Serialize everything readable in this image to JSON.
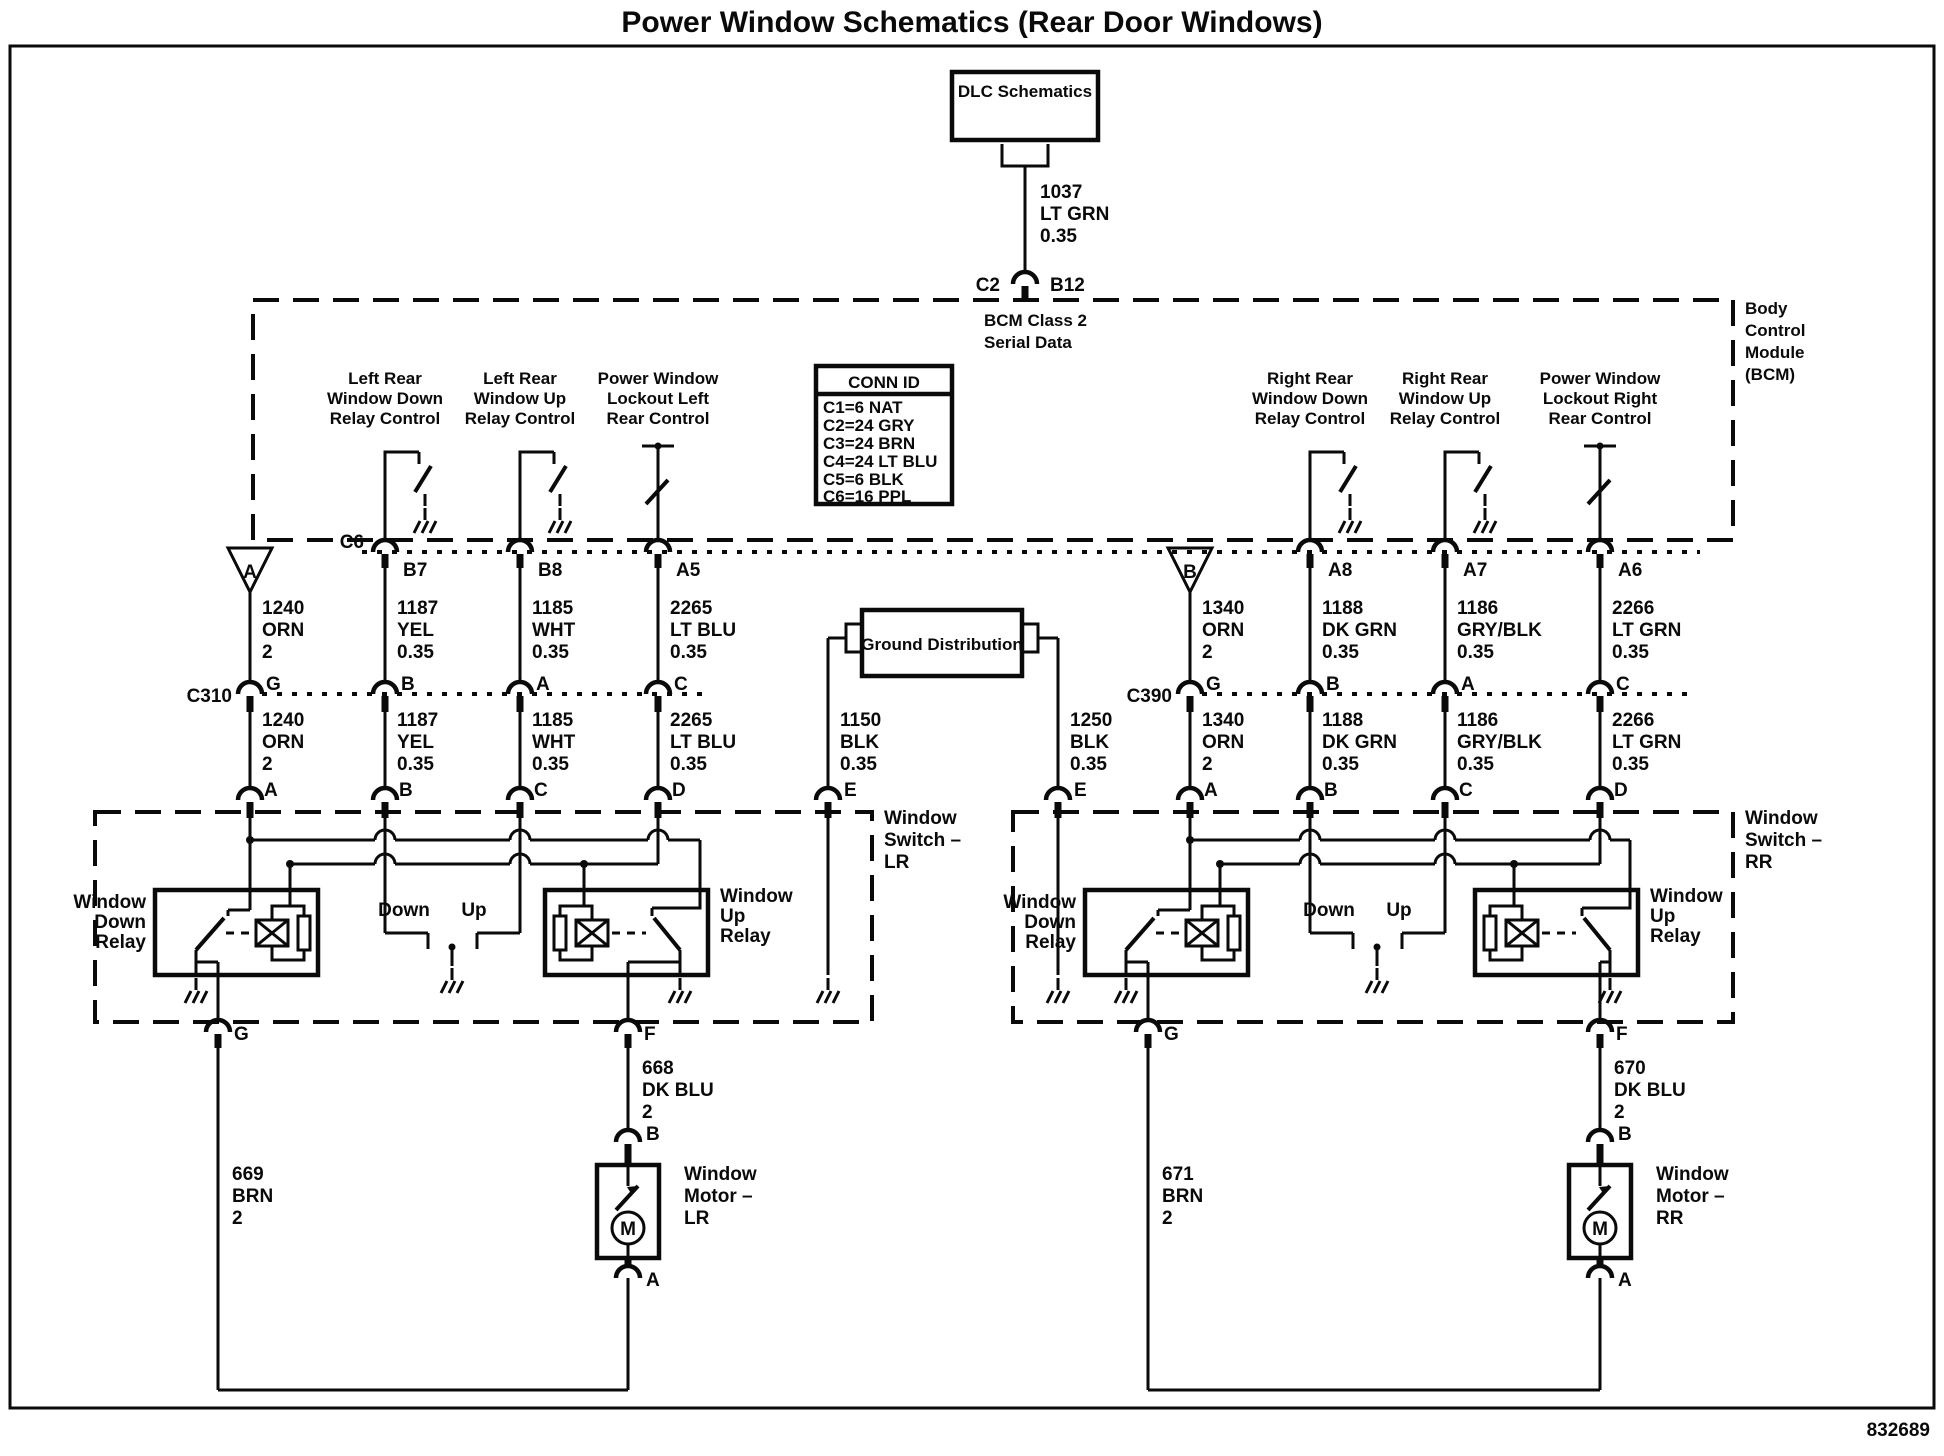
{
  "title": "Power Window Schematics (Rear Door Windows)",
  "ref_number": "832689",
  "dlc": {
    "label": "DLC Schematics"
  },
  "class2": {
    "circuit": "1037",
    "color": "LT GRN",
    "gauge": "0.35",
    "pin_left": "C2",
    "pin_right": "B12",
    "line1": "BCM Class 2",
    "line2": "Serial Data"
  },
  "bcm": {
    "name": [
      "Body",
      "Control",
      "Module",
      "(BCM)"
    ],
    "conn_c6": "C6",
    "conn_id": {
      "title": "CONN ID",
      "rows": [
        "C1=6 NAT",
        "C2=24 GRY",
        "C3=24 BRN",
        "C4=24 LT BLU",
        "C5=6 BLK",
        "C6=16 PPL"
      ]
    },
    "outputs": [
      {
        "l1": "Left Rear",
        "l2": "Window Down",
        "l3": "Relay Control",
        "pin": "B7"
      },
      {
        "l1": "Left Rear",
        "l2": "Window Up",
        "l3": "Relay Control",
        "pin": "B8"
      },
      {
        "l1": "Power Window",
        "l2": "Lockout Left",
        "l3": "Rear Control",
        "pin": "A5"
      },
      {
        "l1": "Right Rear",
        "l2": "Window Down",
        "l3": "Relay Control",
        "pin": "A8"
      },
      {
        "l1": "Right Rear",
        "l2": "Window Up",
        "l3": "Relay Control",
        "pin": "A7"
      },
      {
        "l1": "Power Window",
        "l2": "Lockout Right",
        "l3": "Rear Control",
        "pin": "A6"
      }
    ]
  },
  "gd": {
    "label": "Ground Distribution"
  },
  "left": {
    "triangle": "A",
    "conn": "C310",
    "cols": [
      {
        "circuit": "1240",
        "color": "ORN",
        "gauge": "2",
        "cpin": "G",
        "spin": "A"
      },
      {
        "circuit": "1187",
        "color": "YEL",
        "gauge": "0.35",
        "cpin": "B",
        "spin": "B"
      },
      {
        "circuit": "1185",
        "color": "WHT",
        "gauge": "0.35",
        "cpin": "A",
        "spin": "C"
      },
      {
        "circuit": "2265",
        "color": "LT BLU",
        "gauge": "0.35",
        "cpin": "C",
        "spin": "D"
      }
    ],
    "gnd": {
      "circuit": "1150",
      "color": "BLK",
      "gauge": "0.35",
      "spin": "E"
    },
    "sw": {
      "name": [
        "Window",
        "Switch –",
        "LR"
      ],
      "down_relay": [
        "Window",
        "Down",
        "Relay"
      ],
      "up_relay": [
        "Window",
        "Up",
        "Relay"
      ],
      "down": "Down",
      "up": "Up",
      "g": "G",
      "f": "F"
    },
    "mot": {
      "name": [
        "Window",
        "Motor –",
        "LR"
      ],
      "b": "B",
      "a": "A",
      "m": "M",
      "up_wire": {
        "circuit": "668",
        "color": "DK BLU",
        "gauge": "2"
      },
      "gnd_wire": {
        "circuit": "669",
        "color": "BRN",
        "gauge": "2"
      }
    }
  },
  "right": {
    "triangle": "B",
    "conn": "C390",
    "cols": [
      {
        "circuit": "1340",
        "color": "ORN",
        "gauge": "2",
        "cpin": "G",
        "spin": "A"
      },
      {
        "circuit": "1188",
        "color": "DK GRN",
        "gauge": "0.35",
        "cpin": "B",
        "spin": "B"
      },
      {
        "circuit": "1186",
        "color": "GRY/BLK",
        "gauge": "0.35",
        "cpin": "A",
        "spin": "C"
      },
      {
        "circuit": "2266",
        "color": "LT GRN",
        "gauge": "0.35",
        "cpin": "C",
        "spin": "D"
      }
    ],
    "gnd": {
      "circuit": "1250",
      "color": "BLK",
      "gauge": "0.35",
      "spin": "E"
    },
    "sw": {
      "name": [
        "Window",
        "Switch –",
        "RR"
      ],
      "down_relay": [
        "Window",
        "Down",
        "Relay"
      ],
      "up_relay": [
        "Window",
        "Up",
        "Relay"
      ],
      "down": "Down",
      "up": "Up",
      "g": "G",
      "f": "F"
    },
    "mot": {
      "name": [
        "Window",
        "Motor –",
        "RR"
      ],
      "b": "B",
      "a": "A",
      "m": "M",
      "up_wire": {
        "circuit": "670",
        "color": "DK BLU",
        "gauge": "2"
      },
      "gnd_wire": {
        "circuit": "671",
        "color": "BRN",
        "gauge": "2"
      }
    }
  }
}
